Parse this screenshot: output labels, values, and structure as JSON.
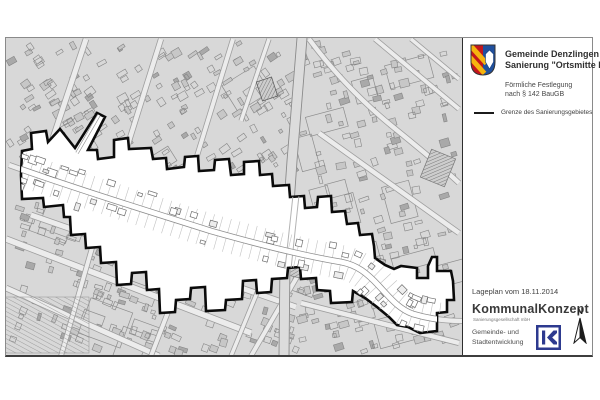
{
  "header": {
    "municipality": "Gemeinde Denzlingen",
    "project": "Sanierung \"Ortsmitte II\"",
    "subtitle_line1": "Förmliche Festlegung",
    "subtitle_line2": "nach § 142 BauGB"
  },
  "legend": {
    "items": [
      {
        "symbol": "boundary-line",
        "label": "Grenze des Sanierungsgebietes"
      }
    ]
  },
  "footer": {
    "date_label": "Lageplan vom 18.11.2014",
    "company": "KommunalKonzept",
    "company_sub": "Sanierungsgesellschaft mbH",
    "department_line1": "Gemeinde- und",
    "department_line2": "Stadtentwicklung",
    "north_label": "N"
  },
  "map": {
    "kind": "cadastral-site-plan",
    "highlighted_area": "Sanierungsgebiet Ortsmitte II",
    "boundary_style": "thick black outline, white fill"
  },
  "colors": {
    "map_background": "#d8d8d8",
    "boundary": "#0b0b0b",
    "crest_red": "#c4161c",
    "crest_gold": "#f6b40e",
    "crest_blue": "#20509e",
    "logo_navy": "#2d3a8f"
  }
}
